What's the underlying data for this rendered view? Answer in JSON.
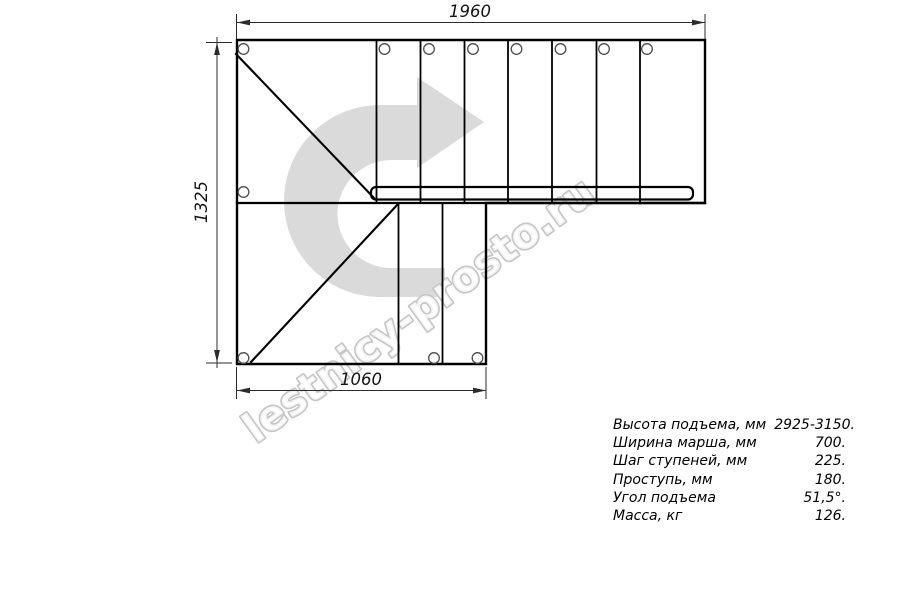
{
  "drawing": {
    "dimensions": {
      "top": "1960",
      "left": "1325",
      "bottom": "1060"
    }
  },
  "watermark": {
    "text": "lestnicy-prosto.ru",
    "arrow_icon": "u-turn-right-arrow",
    "arrow_color": "#dadada",
    "outline_color": "#c6c6c6"
  },
  "specs": {
    "rows": [
      {
        "label": "Высота подъема, мм",
        "value": "2925-3150."
      },
      {
        "label": "Ширина марша, мм",
        "value": "700."
      },
      {
        "label": "Шаг ступеней, мм",
        "value": "225."
      },
      {
        "label": "Проступь, мм",
        "value": "180."
      },
      {
        "label": "Угол подъема",
        "value": "51,5°."
      },
      {
        "label": "Масса, кг",
        "value": "126."
      }
    ]
  }
}
